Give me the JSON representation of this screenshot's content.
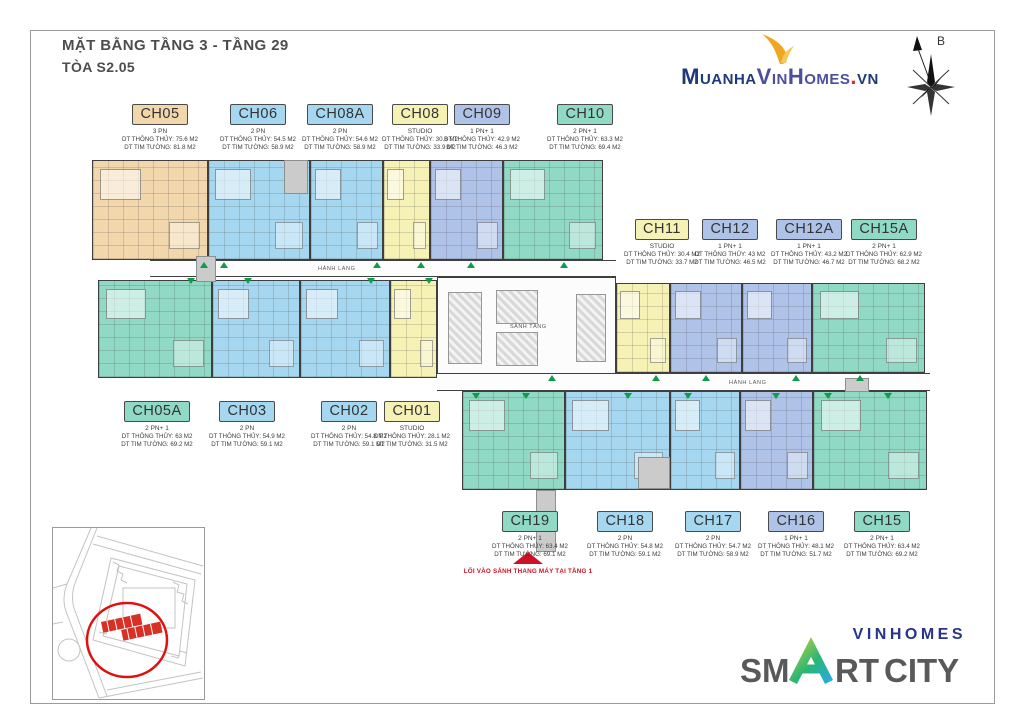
{
  "title": {
    "line1": "MẶT BẰNG TẦNG 3 - TẦNG 29",
    "line2": "TÒA S2.05"
  },
  "site_logo": {
    "muanha": "Muanha",
    "vinhomes": "VinHomes",
    "dot": ".",
    "vn": "vn",
    "swoosh_color": "#f0a61f"
  },
  "compass": {
    "north_label": "B"
  },
  "plan": {
    "corridor_label": "HÀNH LANG",
    "lobby_label": "SẢNH TẦNG",
    "entry_note": "LỐI VÀO SẢNH THANG MÁY TẠI TẦNG 1",
    "marker_color": "#0e9b4a",
    "entry_color": "#ce1126"
  },
  "units": [
    {
      "code": "CH05",
      "type": "3 PN",
      "area_clear": "DT THÔNG THỦY: 75.6 M2",
      "area_wall": "DT TIM TƯỜNG: 81.8 M2",
      "color": "#f2d7ac"
    },
    {
      "code": "CH06",
      "type": "2 PN",
      "area_clear": "DT THÔNG THỦY: 54.5 M2",
      "area_wall": "DT TIM TƯỜNG: 58.9 M2",
      "color": "#a5d8f0"
    },
    {
      "code": "CH08A",
      "type": "2 PN",
      "area_clear": "DT THÔNG THỦY: 54.6 M2",
      "area_wall": "DT TIM TƯỜNG: 58.9 M2",
      "color": "#a5d8f0"
    },
    {
      "code": "CH08",
      "type": "STUDIO",
      "area_clear": "DT THÔNG THỦY: 30.8 M2",
      "area_wall": "DT TIM TƯỜNG: 33.9 M2",
      "color": "#f6f1b4"
    },
    {
      "code": "CH09",
      "type": "1 PN+ 1",
      "area_clear": "DT THÔNG THỦY: 42.9 M2",
      "area_wall": "DT TIM TƯỜNG: 46.3 M2",
      "color": "#afc3e8"
    },
    {
      "code": "CH10",
      "type": "2 PN+ 1",
      "area_clear": "DT THÔNG THỦY: 63.3 M2",
      "area_wall": "DT TIM TƯỜNG: 69.4 M2",
      "color": "#90d9c4"
    },
    {
      "code": "CH11",
      "type": "STUDIO",
      "area_clear": "DT THÔNG THỦY: 30.4 M2",
      "area_wall": "DT TIM TƯỜNG: 33.7 M2",
      "color": "#f6f1b4"
    },
    {
      "code": "CH12",
      "type": "1 PN+ 1",
      "area_clear": "DT THÔNG THỦY: 43 M2",
      "area_wall": "DT TIM TƯỜNG: 46.5 M2",
      "color": "#afc3e8"
    },
    {
      "code": "CH12A",
      "type": "1 PN+ 1",
      "area_clear": "DT THÔNG THỦY: 43.2 M2",
      "area_wall": "DT TIM TƯỜNG: 46.7 M2",
      "color": "#afc3e8"
    },
    {
      "code": "CH15A",
      "type": "2 PN+ 1",
      "area_clear": "DT THÔNG THỦY: 62.9 M2",
      "area_wall": "DT TIM TƯỜNG: 68.2 M2",
      "color": "#90d9c4"
    },
    {
      "code": "CH05A",
      "type": "2 PN+ 1",
      "area_clear": "DT THÔNG THỦY: 63 M2",
      "area_wall": "DT TIM TƯỜNG: 69.2 M2",
      "color": "#90d9c4"
    },
    {
      "code": "CH03",
      "type": "2 PN",
      "area_clear": "DT THÔNG THỦY: 54.9 M2",
      "area_wall": "DT TIM TƯỜNG: 59.1 M2",
      "color": "#a5d8f0"
    },
    {
      "code": "CH02",
      "type": "2 PN",
      "area_clear": "DT THÔNG THỦY: 54.8 M2",
      "area_wall": "DT TIM TƯỜNG: 59.1 M2",
      "color": "#a5d8f0"
    },
    {
      "code": "CH01",
      "type": "STUDIO",
      "area_clear": "DT THÔNG THỦY: 28.1 M2",
      "area_wall": "DT TIM TƯỜNG: 31.5 M2",
      "color": "#f6f1b4"
    },
    {
      "code": "CH19",
      "type": "2 PN+ 1",
      "area_clear": "DT THÔNG THỦY: 63.4 M2",
      "area_wall": "DT TIM TƯỜNG: 69.1 M2",
      "color": "#90d9c4"
    },
    {
      "code": "CH18",
      "type": "2 PN",
      "area_clear": "DT THÔNG THỦY: 54.8 M2",
      "area_wall": "DT TIM TƯỜNG: 59.1 M2",
      "color": "#a5d8f0"
    },
    {
      "code": "CH17",
      "type": "2 PN",
      "area_clear": "DT THÔNG THỦY: 54.7 M2",
      "area_wall": "DT TIM TƯỜNG: 58.9 M2",
      "color": "#a5d8f0"
    },
    {
      "code": "CH16",
      "type": "1 PN+ 1",
      "area_clear": "DT THÔNG THỦY: 48.1 M2",
      "area_wall": "DT TIM TƯỜNG: 51.7 M2",
      "color": "#afc3e8"
    },
    {
      "code": "CH15",
      "type": "2 PN+ 1",
      "area_clear": "DT THÔNG THỦY: 63.4 M2",
      "area_wall": "DT TIM TƯỜNG: 69.2 M2",
      "color": "#90d9c4"
    }
  ],
  "footer_logo": {
    "brand": "VINHOMES",
    "seg_sm": "SM",
    "seg_rt": "RT",
    "seg_city": "CITY",
    "brand_color": "#27348b",
    "gray_color": "#58595b"
  }
}
